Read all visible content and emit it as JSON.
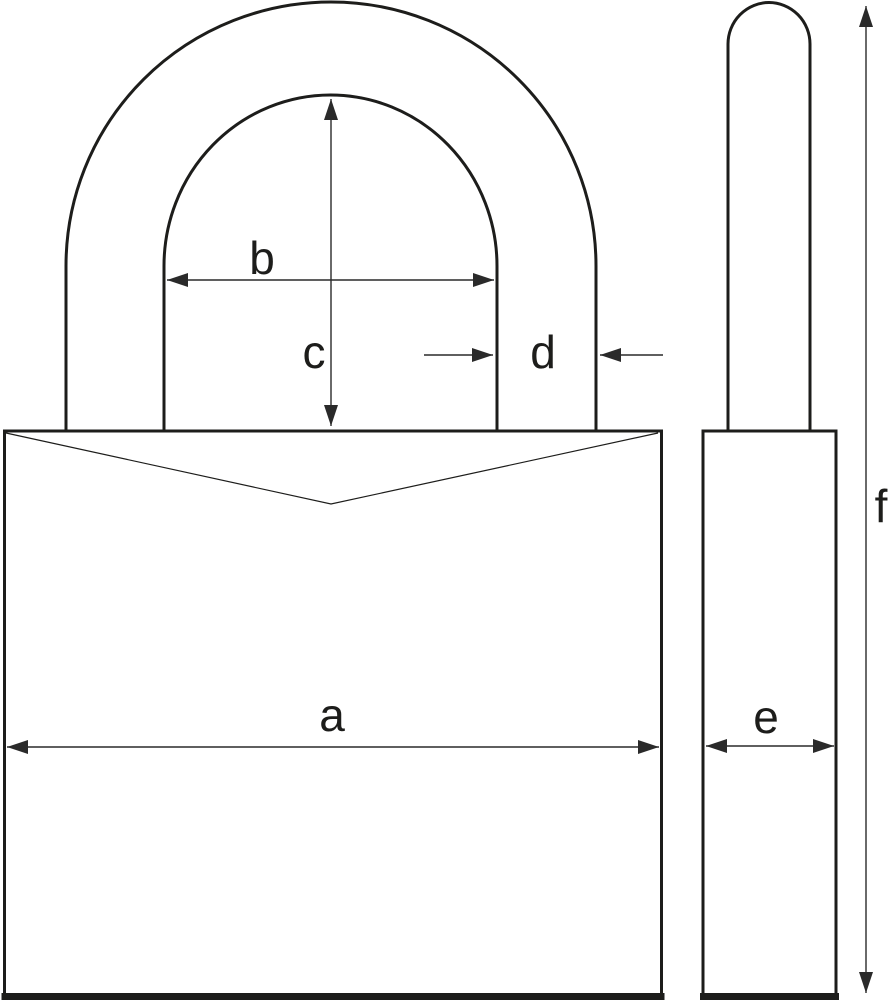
{
  "diagram": {
    "dimension_labels": {
      "a": "a",
      "b": "b",
      "c": "c",
      "d": "d",
      "e": "e",
      "f": "f"
    }
  },
  "colors": {
    "outline": "#1d1d1b",
    "dimension": "#2a2a2a",
    "background": "#ffffff"
  }
}
